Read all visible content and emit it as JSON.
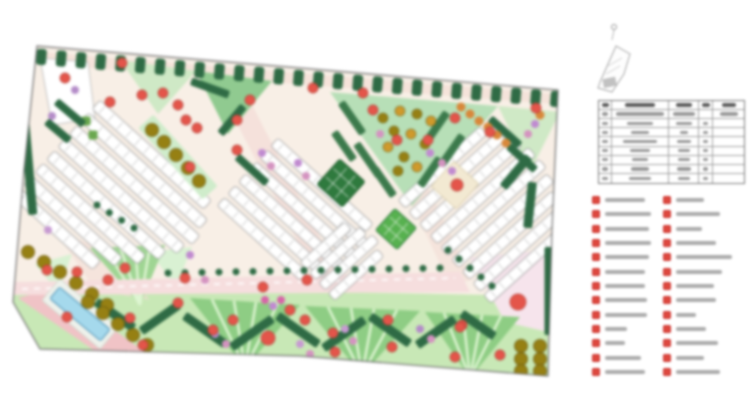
{
  "palette": {
    "canvas_bg": "#ffffff",
    "site_base": "#f8efe6",
    "boundary_stroke": "#6f6f6f",
    "hedge_dark": "#2f6b45",
    "tree_red": "#e4554a",
    "tree_olive": "#968013",
    "flower_orange": "#cf9a2c",
    "lawn": "#c8e8b6",
    "lawn_dark": "#8ecd84",
    "lawn_stripe": "#def5d2",
    "lawn_light": "#d9f1d3",
    "wedge_green": "#b7dfb7",
    "wedge_light": "#cfe9c6",
    "wedge_mid": "#90ca90",
    "road_pink": "#f6dede",
    "path_rose": "#f0c3c6",
    "plaza_pink": "#f6e4ec",
    "pool_blue": "#a5d9ec",
    "accent_purple": "#c08ad0",
    "accent_magenta": "#d493c0",
    "accent_lavender": "#b48cc8",
    "building_fill": "#ffffff",
    "building_stroke": "#9a9a9a",
    "building_tick": "#c0c0c0",
    "legend_marker": "#e0493f",
    "text_smudge": "#8a8a8a",
    "table_line": "#8f8f8f",
    "square_dark": "#2f7a3e",
    "square_grid": "#57b14f"
  },
  "plan": {
    "boundary": "37,46 300,68 558,90 552,230 548,376 300,356 40,349 13,302 24,170",
    "polys": [
      {
        "p": "40,52 556,94 554,104 38,64",
        "f": "#f5e3da"
      },
      {
        "p": "225,100 247,95 347,290 325,295",
        "f": "#f3dcd6",
        "o": 0.7
      },
      {
        "p": "368,112 390,107 472,280 450,285",
        "f": "#f3dcd6",
        "o": 0.6
      },
      {
        "p": "13,286 548,296 548,376 300,356 40,349 13,302",
        "f": "#c8e8b6"
      },
      {
        "p": "55,230 100,248 150,300 95,290",
        "f": "#f3dcd6",
        "o": 0.6
      },
      {
        "p": "120,60 196,71 158,114",
        "f": "#cfe9c6"
      },
      {
        "p": "196,71 272,81 228,134",
        "f": "#90ca90"
      },
      {
        "p": "330,92 498,106 412,206",
        "f": "#b7dfb7"
      },
      {
        "p": "498,106 560,112 530,172",
        "f": "#cfe9c6"
      },
      {
        "p": "35,264 72,254 58,292",
        "f": "#d9f1d3"
      },
      {
        "p": "150,252 192,247 176,287",
        "f": "#d9f1d3"
      },
      {
        "p": "18,298 55,288 145,352 108,360",
        "f": "#f0c3c6"
      },
      {
        "p": "470,258 548,250 548,332 505,322",
        "f": "#f6e4ec"
      },
      {
        "p": "40,58 88,62 95,118 52,125",
        "f": "#ffffff",
        "s": "#b5b5b5",
        "sw": 0.8
      }
    ],
    "lawnTris": [
      {
        "p": [
          [
            90,
            248
          ],
          [
            165,
            245
          ],
          [
            140,
            305
          ]
        ],
        "f": "#9fd593"
      },
      {
        "p": [
          [
            190,
            298
          ],
          [
            300,
            305
          ],
          [
            245,
            368
          ]
        ],
        "f": "#8ecd84"
      },
      {
        "p": [
          [
            305,
            306
          ],
          [
            420,
            311
          ],
          [
            362,
            375
          ]
        ],
        "f": "#8ecd84"
      },
      {
        "p": [
          [
            425,
            312
          ],
          [
            520,
            317
          ],
          [
            470,
            378
          ]
        ],
        "f": "#8ecd84"
      }
    ],
    "road": {
      "p": "13,282 460,272 470,292 13,295",
      "f": "#f6dede",
      "dash": {
        "x1": 22,
        "y1": 289,
        "x2": 455,
        "y2": 278
      }
    },
    "clusters": [
      {
        "x": 100,
        "y": 100,
        "angle": 42,
        "gap": 17,
        "width": 12,
        "rows": [
          150,
          160,
          165,
          160,
          150,
          138,
          122,
          108
        ]
      },
      {
        "x": 278,
        "y": 138,
        "angle": 42,
        "gap": 16,
        "width": 11,
        "rows": [
          128,
          136,
          140,
          136,
          126,
          112
        ]
      },
      {
        "x": 398,
        "y": 200,
        "angle": -42,
        "gap": 16,
        "width": 11,
        "rows": [
          110,
          120,
          128,
          132,
          132,
          128,
          120,
          110,
          96
        ]
      },
      {
        "x": 300,
        "y": 262,
        "angle": -42,
        "gap": 14,
        "width": 10,
        "rows": [
          60,
          68,
          72,
          66
        ]
      }
    ],
    "rrects": [
      {
        "cx": 178,
        "cy": 157,
        "w": 96,
        "h": 20,
        "a": 48,
        "f": "#cfeccb"
      },
      {
        "cx": 80,
        "cy": 314,
        "w": 76,
        "h": 28,
        "a": 40,
        "f": "#eef2ec",
        "s": "#cfd8cc",
        "sw": 0.8
      },
      {
        "cx": 80,
        "cy": 314,
        "w": 66,
        "h": 15,
        "a": 40,
        "f": "#a5d9ec",
        "s": "#4f93b8",
        "sw": 1
      },
      {
        "cx": 455,
        "cy": 185,
        "w": 34,
        "h": 34,
        "a": 42,
        "f": "#f2e9d2",
        "s": "#d8cba8",
        "sw": 0.8
      },
      {
        "cx": 341,
        "cy": 183,
        "w": 34,
        "h": 34,
        "a": 42,
        "f": "#2f7a3e",
        "s": "#1d5a2a",
        "sw": 1,
        "inner": "cross"
      },
      {
        "cx": 396,
        "cy": 229,
        "w": 29,
        "h": 29,
        "a": 42,
        "f": "#57b14f",
        "s": "#2f7a3e",
        "sw": 1,
        "inner": "grid"
      },
      {
        "cx": 86,
        "cy": 121,
        "w": 9,
        "h": 9,
        "a": 0,
        "f": "#6aa84f"
      },
      {
        "cx": 93,
        "cy": 135,
        "w": 9,
        "h": 9,
        "a": 0,
        "f": "#6aa84f"
      },
      {
        "cx": 26,
        "cy": 136,
        "w": 9,
        "h": 158,
        "a": -5,
        "f": "#2f6b45"
      },
      {
        "cx": 549,
        "cy": 291,
        "w": 9,
        "h": 88,
        "a": 0,
        "f": "#2f6b45"
      },
      {
        "cx": 70,
        "cy": 113,
        "w": 36,
        "h": 8,
        "a": 40,
        "f": "#2f6b45"
      },
      {
        "cx": 58,
        "cy": 131,
        "w": 30,
        "h": 8,
        "a": 40,
        "f": "#2f6b45"
      },
      {
        "cx": 210,
        "cy": 88,
        "w": 40,
        "h": 8,
        "a": 20,
        "f": "#2f6b45"
      },
      {
        "cx": 232,
        "cy": 120,
        "w": 36,
        "h": 8,
        "a": -50,
        "f": "#2f6b45"
      },
      {
        "cx": 352,
        "cy": 118,
        "w": 38,
        "h": 8,
        "a": 55,
        "f": "#3c7a4c"
      },
      {
        "cx": 344,
        "cy": 146,
        "w": 34,
        "h": 8,
        "a": 55,
        "f": "#3c7a4c"
      },
      {
        "cx": 368,
        "cy": 160,
        "w": 40,
        "h": 8,
        "a": 55,
        "f": "#3c7a4c"
      },
      {
        "cx": 384,
        "cy": 182,
        "w": 34,
        "h": 8,
        "a": 55,
        "f": "#3c7a4c"
      },
      {
        "cx": 436,
        "cy": 128,
        "w": 38,
        "h": 8,
        "a": -55,
        "f": "#3c7a4c"
      },
      {
        "cx": 452,
        "cy": 150,
        "w": 36,
        "h": 8,
        "a": -55,
        "f": "#3c7a4c"
      },
      {
        "cx": 430,
        "cy": 172,
        "w": 34,
        "h": 8,
        "a": -55,
        "f": "#3c7a4c"
      },
      {
        "cx": 505,
        "cy": 132,
        "w": 40,
        "h": 8,
        "a": 42,
        "f": "#2f6b45"
      },
      {
        "cx": 522,
        "cy": 158,
        "w": 36,
        "h": 8,
        "a": 42,
        "f": "#2f6b45"
      },
      {
        "cx": 252,
        "cy": 170,
        "w": 40,
        "h": 8,
        "a": 42,
        "f": "#2f6b45"
      },
      {
        "cx": 516,
        "cy": 172,
        "w": 9,
        "h": 40,
        "a": 40,
        "f": "#2f6b45"
      },
      {
        "cx": 530,
        "cy": 205,
        "w": 9,
        "h": 46,
        "a": 6,
        "f": "#2f6b45"
      },
      {
        "cx": 115,
        "cy": 315,
        "w": 46,
        "h": 9,
        "a": 35,
        "f": "#2f6b45"
      },
      {
        "cx": 160,
        "cy": 318,
        "w": 46,
        "h": 9,
        "a": -35,
        "f": "#2f6b45"
      },
      {
        "cx": 205,
        "cy": 330,
        "w": 50,
        "h": 9,
        "a": 35,
        "f": "#2f6b45"
      },
      {
        "cx": 252,
        "cy": 333,
        "w": 50,
        "h": 9,
        "a": -35,
        "f": "#2f6b45"
      },
      {
        "cx": 298,
        "cy": 330,
        "w": 50,
        "h": 9,
        "a": 35,
        "f": "#2f6b45"
      },
      {
        "cx": 344,
        "cy": 334,
        "w": 50,
        "h": 9,
        "a": -35,
        "f": "#2f6b45"
      },
      {
        "cx": 390,
        "cy": 330,
        "w": 48,
        "h": 9,
        "a": 35,
        "f": "#2f6b45"
      },
      {
        "cx": 436,
        "cy": 332,
        "w": 46,
        "h": 9,
        "a": -35,
        "f": "#2f6b45"
      },
      {
        "cx": 478,
        "cy": 325,
        "w": 40,
        "h": 9,
        "a": 35,
        "f": "#2f6b45"
      }
    ],
    "topHedge": {
      "x1": 42,
      "y1": 50,
      "x2": 556,
      "y2": 92,
      "n": 27,
      "w": 10,
      "h": 16,
      "off": 7
    },
    "greenDotRows": [
      {
        "x1": 168,
        "y1": 273,
        "x2": 440,
        "y2": 268,
        "n": 17,
        "r": 3.5
      },
      {
        "x1": 448,
        "y1": 250,
        "x2": 492,
        "y2": 286,
        "n": 5,
        "r": 3.5
      },
      {
        "x1": 97,
        "y1": 205,
        "x2": 134,
        "y2": 228,
        "n": 4,
        "r": 3.5
      }
    ],
    "olive": [
      [
        152,
        130
      ],
      [
        164,
        142
      ],
      [
        176,
        155
      ],
      [
        188,
        168
      ],
      [
        199,
        181
      ],
      [
        28,
        252
      ],
      [
        44,
        262
      ],
      [
        60,
        272
      ],
      [
        76,
        283
      ],
      [
        92,
        294
      ],
      [
        107,
        305
      ],
      [
        88,
        302
      ],
      [
        103,
        313
      ],
      [
        118,
        324
      ],
      [
        133,
        335
      ],
      [
        147,
        345
      ],
      [
        521,
        346
      ],
      [
        521,
        359
      ],
      [
        521,
        371
      ],
      [
        540,
        346
      ],
      [
        540,
        359
      ],
      [
        540,
        371
      ]
    ],
    "oliveCluster": [
      [
        383,
        118
      ],
      [
        400,
        111
      ],
      [
        417,
        114
      ],
      [
        431,
        121
      ],
      [
        394,
        131
      ],
      [
        411,
        134
      ],
      [
        425,
        144
      ],
      [
        388,
        147
      ],
      [
        404,
        157
      ],
      [
        417,
        167
      ],
      [
        398,
        171
      ]
    ],
    "orange": [
      [
        488,
        127
      ],
      [
        497,
        135
      ],
      [
        479,
        121
      ],
      [
        470,
        114
      ],
      [
        461,
        107
      ],
      [
        506,
        143
      ],
      [
        540,
        115
      ]
    ],
    "purple": [
      [
        75,
        90,
        "#b48cc8"
      ],
      [
        52,
        116,
        "#b48cc8"
      ],
      [
        48,
        230,
        "#c79ad2"
      ],
      [
        298,
        163,
        "#c08ad0"
      ],
      [
        306,
        176,
        "#d493c0"
      ],
      [
        262,
        153,
        "#c08ad0"
      ],
      [
        271,
        166,
        "#d493c0"
      ],
      [
        430,
        153,
        "#c08ad0"
      ],
      [
        442,
        163,
        "#d493c0"
      ],
      [
        452,
        171,
        "#c08ad0"
      ],
      [
        535,
        124,
        "#c08ad0"
      ],
      [
        528,
        134,
        "#d493c0"
      ],
      [
        215,
        334,
        "#b48cc8"
      ],
      [
        226,
        344,
        "#d493c0"
      ],
      [
        255,
        358,
        "#b48cc8"
      ],
      [
        345,
        329,
        "#c79ad2"
      ],
      [
        353,
        341,
        "#d493c0"
      ],
      [
        420,
        329,
        "#b48cc8"
      ],
      [
        431,
        339,
        "#d493c0"
      ],
      [
        300,
        344,
        "#c79ad2"
      ],
      [
        310,
        354,
        "#d493c0"
      ],
      [
        380,
        134,
        "#d493c0"
      ],
      [
        265,
        300,
        "#d765a8"
      ],
      [
        273,
        306,
        "#c08ad0"
      ],
      [
        281,
        300,
        "#d765a8"
      ],
      [
        205,
        280,
        "#d493c0"
      ],
      [
        190,
        255,
        "#c08ad0"
      ]
    ],
    "red": [
      [
        65,
        78
      ],
      [
        122,
        63
      ],
      [
        110,
        102
      ],
      [
        142,
        95
      ],
      [
        163,
        93
      ],
      [
        178,
        105
      ],
      [
        197,
        128
      ],
      [
        237,
        120
      ],
      [
        250,
        100
      ],
      [
        237,
        150
      ],
      [
        313,
        88
      ],
      [
        363,
        93
      ],
      [
        373,
        110
      ],
      [
        455,
        118
      ],
      [
        397,
        140
      ],
      [
        428,
        140
      ],
      [
        490,
        132
      ],
      [
        536,
        108
      ],
      [
        186,
        120
      ],
      [
        190,
        167
      ],
      [
        457,
        185,
        6
      ],
      [
        518,
        302,
        8
      ],
      [
        462,
        325
      ],
      [
        455,
        357
      ],
      [
        500,
        355
      ],
      [
        333,
        333
      ],
      [
        388,
        320
      ],
      [
        460,
        327
      ],
      [
        392,
        347
      ],
      [
        290,
        310
      ],
      [
        335,
        352
      ],
      [
        178,
        303
      ],
      [
        233,
        320
      ],
      [
        213,
        330
      ],
      [
        268,
        338,
        7
      ],
      [
        305,
        320
      ],
      [
        185,
        278
      ],
      [
        263,
        287
      ],
      [
        307,
        280
      ],
      [
        47,
        270
      ],
      [
        77,
        272
      ],
      [
        125,
        268
      ],
      [
        108,
        280
      ],
      [
        67,
        317
      ],
      [
        130,
        318
      ],
      [
        143,
        345
      ]
    ]
  },
  "keymap": {
    "type": "location-sketch"
  },
  "table": {
    "col_widths": [
      13,
      57,
      30,
      14,
      31
    ],
    "rows": [
      {
        "head": true,
        "bars": [
          7,
          30,
          16,
          8,
          14
        ]
      },
      {
        "bars": [
          6,
          48,
          22,
          0,
          18
        ]
      },
      {
        "bars": [
          6,
          26,
          16,
          5,
          0
        ]
      },
      {
        "bars": [
          6,
          18,
          8,
          5,
          0
        ]
      },
      {
        "bars": [
          6,
          34,
          14,
          5,
          0
        ]
      },
      {
        "bars": [
          6,
          20,
          12,
          5,
          0
        ]
      },
      {
        "bars": [
          6,
          16,
          12,
          5,
          0
        ]
      },
      {
        "bars": [
          6,
          18,
          14,
          5,
          0
        ]
      },
      {
        "bars": [
          6,
          22,
          12,
          5,
          0
        ]
      }
    ]
  },
  "legend": {
    "marker_color": "#e0493f",
    "left": [
      {
        "w": 40
      },
      {
        "w": 46
      },
      {
        "w": 44
      },
      {
        "w": 46
      },
      {
        "w": 44
      },
      {
        "w": 40
      },
      {
        "w": 40
      },
      {
        "w": 42
      },
      {
        "w": 42
      },
      {
        "w": 22
      },
      {
        "w": 20
      },
      {
        "w": 36
      },
      {
        "w": 40
      }
    ],
    "right": [
      {
        "w": 28
      },
      {
        "w": 44
      },
      {
        "w": 26
      },
      {
        "w": 40
      },
      {
        "w": 56
      },
      {
        "w": 46
      },
      {
        "w": 38
      },
      {
        "w": 40
      },
      {
        "w": 20
      },
      {
        "w": 30
      },
      {
        "w": 42
      },
      {
        "w": 28
      },
      {
        "w": 44
      }
    ]
  }
}
